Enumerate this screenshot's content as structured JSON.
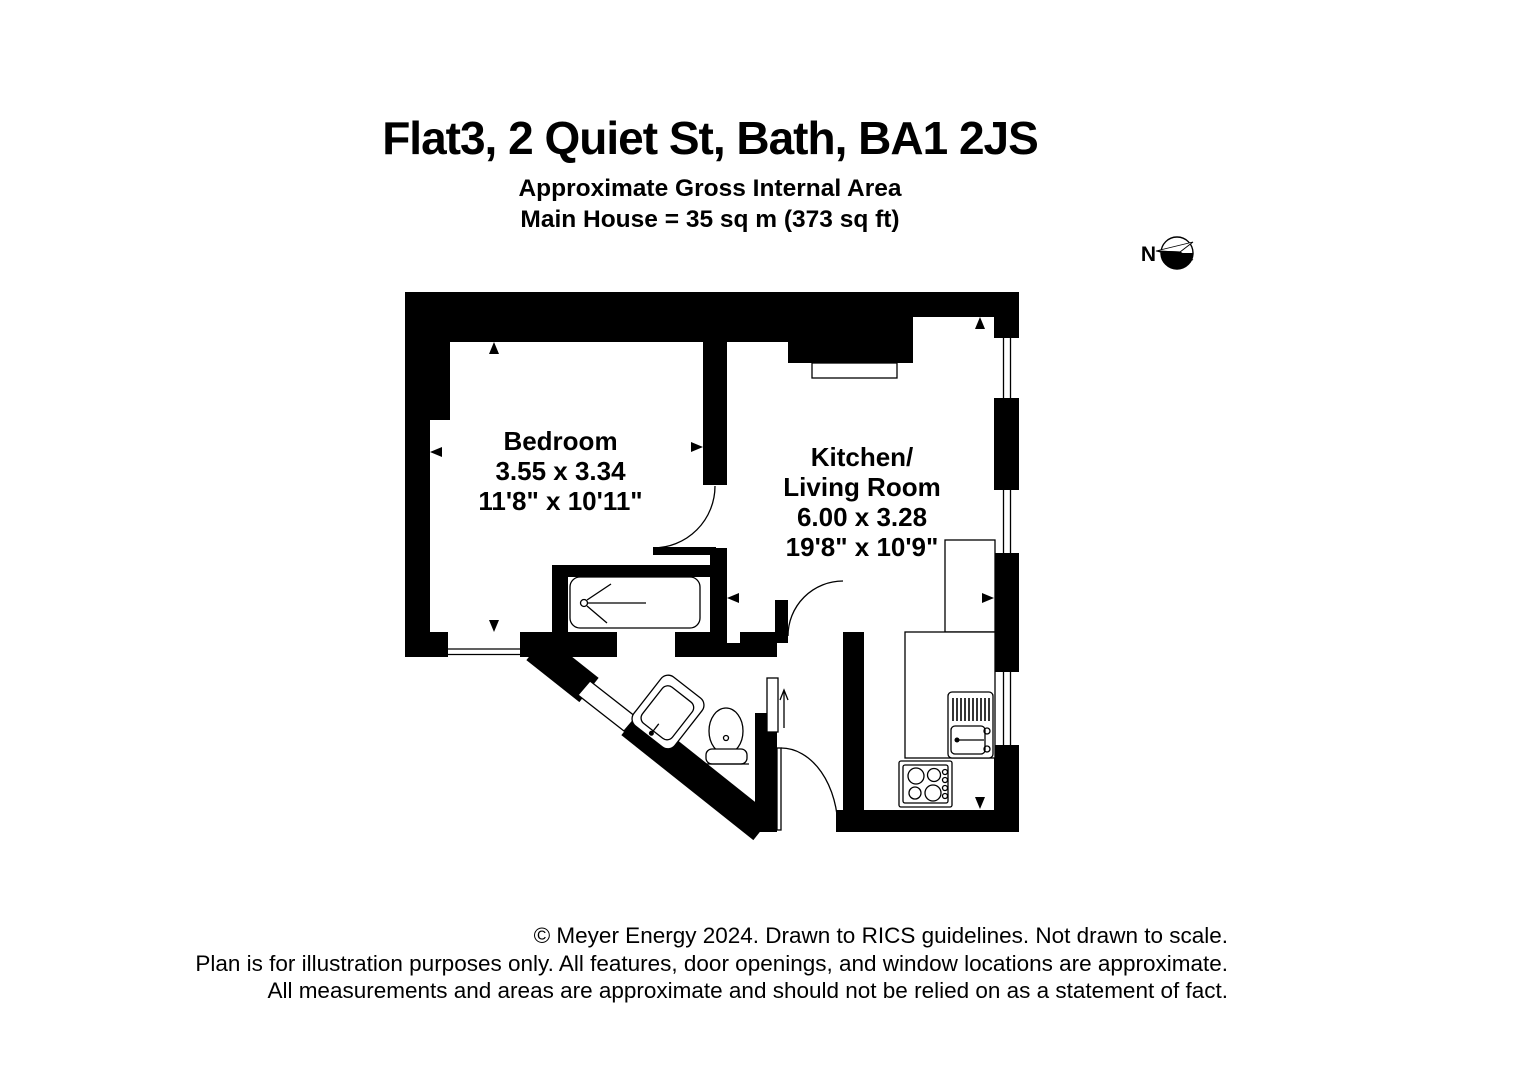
{
  "header": {
    "title": "Flat3, 2 Quiet St, Bath, BA1 2JS",
    "subtitle_line1": "Approximate Gross Internal Area",
    "subtitle_line2": "Main House = 35 sq m (373 sq ft)"
  },
  "compass": {
    "label": "N"
  },
  "rooms": {
    "bedroom": {
      "name": "Bedroom",
      "dimensions_metric": "3.55 x 3.34",
      "dimensions_imperial": "11'8\" x 10'11\""
    },
    "kitchen_living": {
      "name_line1": "Kitchen/",
      "name_line2": "Living Room",
      "dimensions_metric": "6.00 x 3.28",
      "dimensions_imperial": "19'8\" x 10'9\""
    }
  },
  "footer": {
    "line1": "© Meyer Energy 2024. Drawn to RICS guidelines.  Not drawn to scale.",
    "line2": "Plan is for illustration purposes only. All features, door openings, and window locations are approximate.",
    "line3": "All measurements and areas are approximate and should not be relied on as a statement of fact."
  },
  "colors": {
    "wall": "#000000",
    "background": "#ffffff",
    "line": "#000000"
  }
}
